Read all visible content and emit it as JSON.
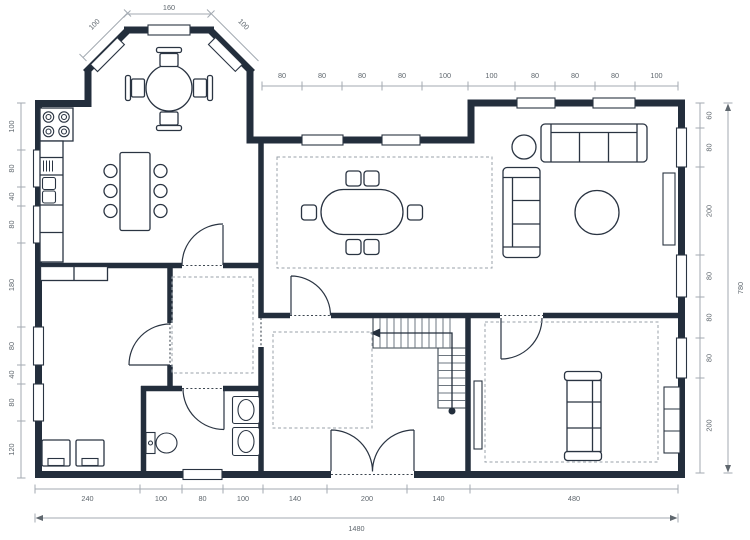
{
  "title": "floor-plan",
  "colors": {
    "background": "#ffffff",
    "wall": "#232e3c",
    "furniture_stroke": "#2a3442",
    "dim_line": "#a3aab2",
    "dim_text": "#5f676e",
    "dashed_rug": "#99a1aa"
  },
  "dims": {
    "bay_top": "160",
    "bay_left": "100",
    "bay_right": "100",
    "top": [
      "80",
      "80",
      "80",
      "80",
      "100",
      "100",
      "80",
      "80",
      "80",
      "100"
    ],
    "left": [
      "100",
      "80",
      "40",
      "80",
      "180",
      "80",
      "40",
      "80",
      "120"
    ],
    "right": [
      "60",
      "80",
      "200",
      "80",
      "80",
      "80",
      "200"
    ],
    "right_total": "780",
    "bottom": [
      "240",
      "100",
      "80",
      "100",
      "140",
      "200",
      "140",
      "480"
    ],
    "bottom_total": "1480"
  },
  "symbols": [
    "stove-icon",
    "kitchen-counter-icon",
    "sink-basin-icon",
    "island-table-icon",
    "stool-icon",
    "bay-round-table-icon",
    "chair-icon",
    "oval-dining-table-icon",
    "sofa-icon",
    "side-table-icon",
    "round-coffee-table-icon",
    "radiator-icon",
    "double-bed-icon",
    "dresser-icon",
    "toilet-icon",
    "bathroom-sink-icon",
    "staircase-icon",
    "stair-direction-arrow-icon",
    "door-swing-icon",
    "window-icon",
    "area-rug-icon"
  ]
}
